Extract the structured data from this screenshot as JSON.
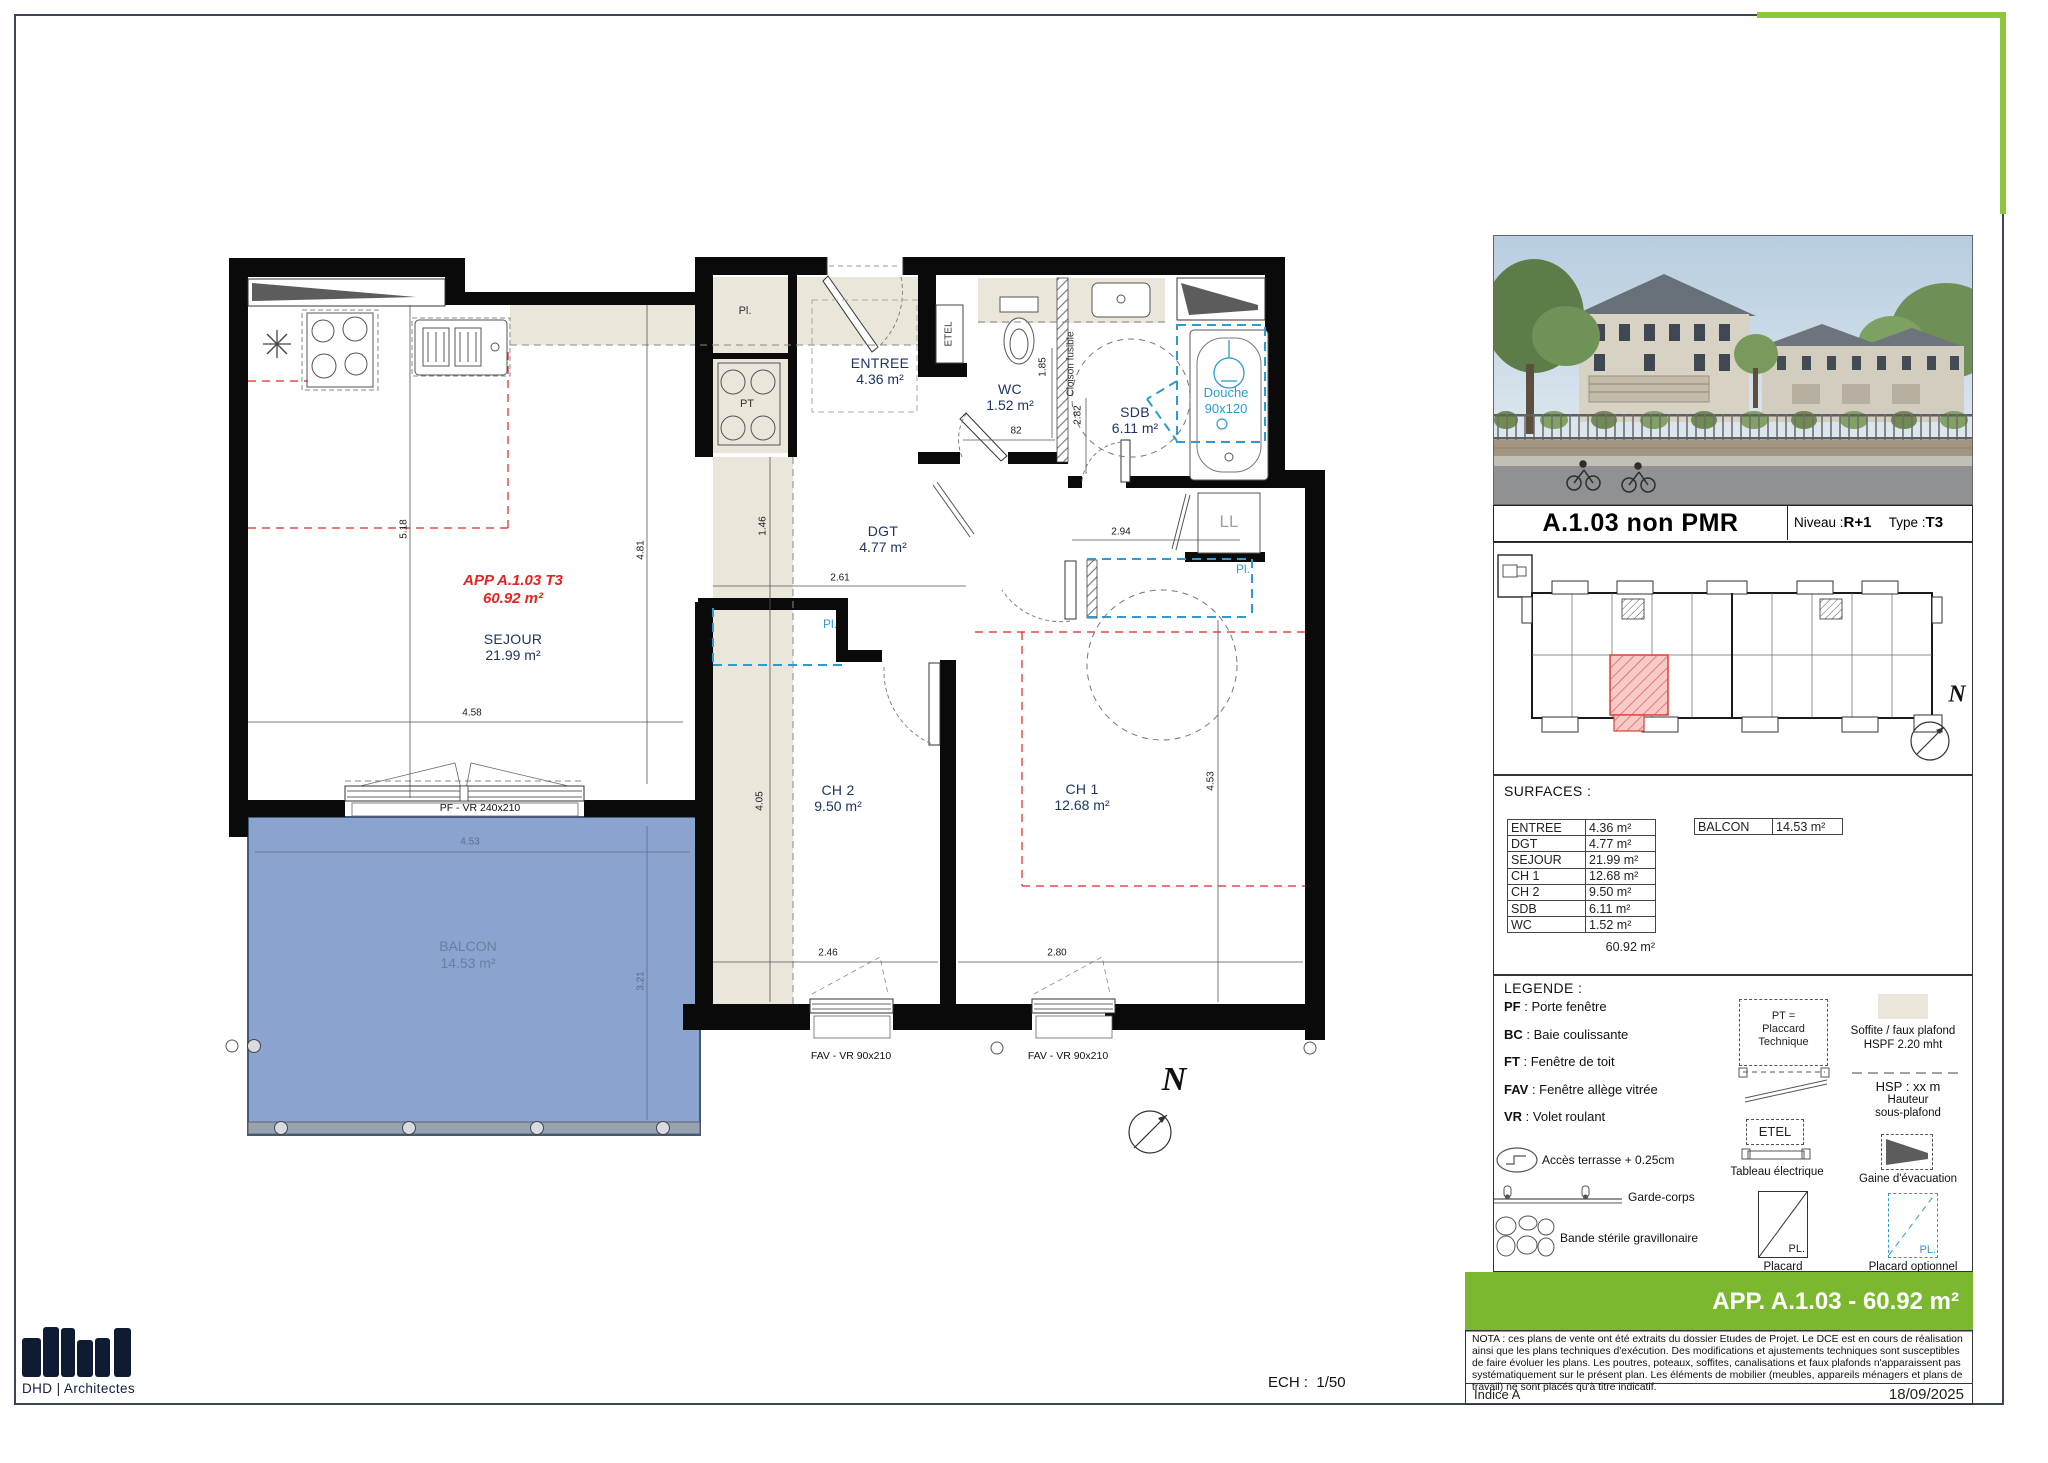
{
  "header": {
    "title": "A.1.03 non PMR",
    "niveau_label": "Niveau :",
    "niveau_value": "R+1",
    "type_label": "Type :",
    "type_value": "T3"
  },
  "surfaces": {
    "title": "SURFACES :",
    "rows": [
      [
        "ENTREE",
        "4.36 m²"
      ],
      [
        "DGT",
        "4.77 m²"
      ],
      [
        "SEJOUR",
        "21.99 m²"
      ],
      [
        "CH 1",
        "12.68 m²"
      ],
      [
        "CH 2",
        "9.50 m²"
      ],
      [
        "SDB",
        "6.11 m²"
      ],
      [
        "WC",
        "1.52 m²"
      ]
    ],
    "total": "60.92 m²",
    "balcon": {
      "name": "BALCON",
      "value": "14.53 m²"
    }
  },
  "legend": {
    "title": "LEGENDE :",
    "abbreviations": [
      {
        "abbr": "PF",
        "label": "Porte fenêtre"
      },
      {
        "abbr": "BC",
        "label": "Baie coulissante"
      },
      {
        "abbr": "FT",
        "label": "Fenêtre de toit"
      },
      {
        "abbr": "FAV",
        "label": "Fenêtre allège vitrée"
      },
      {
        "abbr": "VR",
        "label": "Volet roulant"
      }
    ],
    "acces_terrasse": "Accès terrasse + 0.25cm",
    "garde_corps": "Garde-corps",
    "bande_sterile": "Bande stérile gravillonaire",
    "pt_line1": "PT =",
    "pt_line2": "Placcard",
    "pt_line3": "Technique",
    "etel": "ETEL",
    "tableau": "Tableau électrique",
    "placard_sym": "PL.",
    "placard": "Placard",
    "soffite_line1": "Soffite / faux plafond",
    "soffite_line2": "HSPF 2.20 mht",
    "hsp_line1": "HSP : xx m",
    "hsp_line2": "Hauteur",
    "hsp_line3": "sous-plafond",
    "gaine": "Gaine d'évacuation",
    "placard_opt_sym": "PL.",
    "placard_opt": "Placard optionnel"
  },
  "banner": {
    "text": "APP. A.1.03 - 60.92 m²"
  },
  "nota": "NOTA : ces plans de vente ont été extraits du dossier Etudes de Projet. Le DCE est en cours de réalisation ainsi que les plans techniques d'exécution. Des modifications et ajustements techniques sont susceptibles de faire évoluer les plans. Les poutres, poteaux, soffites, canalisations et faux plafonds n'apparaissent pas systématiquement sur le présent plan. Les éléments de mobilier (meubles, appareils ménagers et plans de travail) ne sont placés qu'à titre indicatif.",
  "footer": {
    "indice": "Indice A",
    "date": "18/09/2025",
    "scale_label": "ECH :",
    "scale_value": "1/50",
    "logo_text": "DHD | Architectes"
  },
  "plan": {
    "app_line1": "APP A.1.03 T3",
    "app_line2": "60.92 m²",
    "rooms": {
      "sejour": {
        "name": "SEJOUR",
        "area": "21.99 m²"
      },
      "entree": {
        "name": "ENTREE",
        "area": "4.36 m²"
      },
      "wc": {
        "name": "WC",
        "area": "1.52 m²"
      },
      "sdb": {
        "name": "SDB",
        "area": "6.11 m²"
      },
      "dgt": {
        "name": "DGT",
        "area": "4.77 m²"
      },
      "ch1": {
        "name": "CH 1",
        "area": "12.68 m²"
      },
      "ch2": {
        "name": "CH 2",
        "area": "9.50 m²"
      },
      "balcon": {
        "name": "BALCON",
        "area": "14.53 m²"
      }
    },
    "labels": {
      "pl": "Pl.",
      "pt": "PT",
      "etel": "ETEL",
      "ll": "LL",
      "pl_opt_ch2": "Pl.",
      "pl_opt_ch1": "Pl.",
      "douche_line1": "Douche",
      "douche_line2": "90x120",
      "cloison": "Cloison fusible",
      "north": "N"
    },
    "windows": {
      "pf": "PF - VR 240x210",
      "fav_ch2": "FAV - VR 90x210",
      "fav_ch1": "FAV - VR 90x210"
    },
    "dims": {
      "sejour_w": "4.58",
      "sejour_h_left": "5.18",
      "sejour_h_right": "4.81",
      "corridor": "1.46",
      "corridor_low": "4.05",
      "dgt_w": "2.61",
      "sdb_w": "2.94",
      "wc_h": "1.85",
      "cloison_h": "2.82",
      "wc_w": "82",
      "ch2_w": "2.46",
      "ch1_w": "2.80",
      "ch1_h": "4.53",
      "balcon_w": "4.53",
      "balcon_h": "3.21"
    }
  },
  "colors": {
    "accent_green": "#7cb82f",
    "frame_green": "#8cc63e",
    "highlight_red": "#e02620",
    "plan_blue": "#2f9ad0",
    "balcony_fill": "#7d9aca",
    "soffite_beige": "#eae6da",
    "logo_navy": "#0e1b33"
  }
}
